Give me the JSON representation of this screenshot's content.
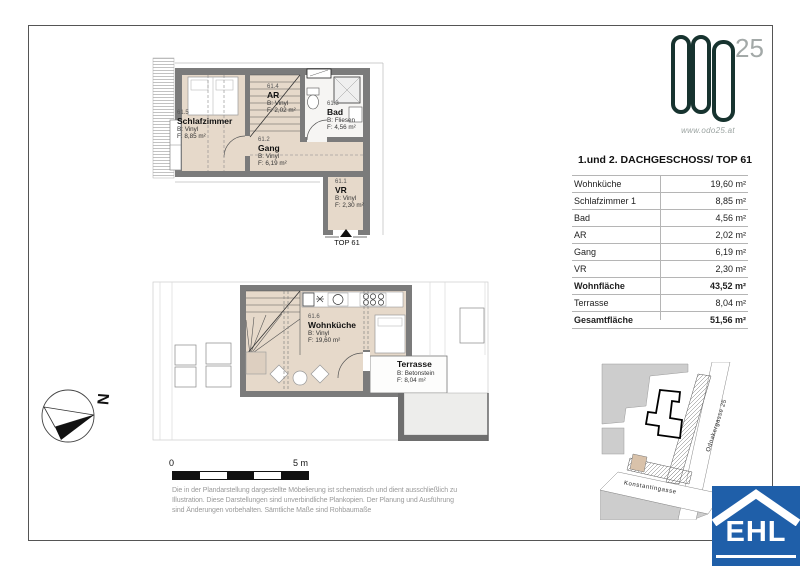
{
  "branding": {
    "logo_number": "25",
    "website": "www.odo25.at",
    "logo_color": "#17332f"
  },
  "title_block": {
    "title": "1.und 2. DACHGESCHOSS/ TOP 61"
  },
  "area_table": {
    "rows": [
      {
        "label": "Wohnküche",
        "value": "19,60 m²",
        "bold": false
      },
      {
        "label": "Schlafzimmer 1",
        "value": "8,85 m²",
        "bold": false
      },
      {
        "label": "Bad",
        "value": "4,56 m²",
        "bold": false
      },
      {
        "label": "AR",
        "value": "2,02 m²",
        "bold": false
      },
      {
        "label": "Gang",
        "value": "6,19 m²",
        "bold": false
      },
      {
        "label": "VR",
        "value": "2,30 m²",
        "bold": false
      },
      {
        "label": "Wohnfläche",
        "value": "43,52 m²",
        "bold": true
      },
      {
        "label": "Terrasse",
        "value": "8,04 m²",
        "bold": false
      },
      {
        "label": "Gesamtfläche",
        "value": "51,56 m²",
        "bold": true
      }
    ]
  },
  "plans": {
    "upper": {
      "rooms": {
        "schlafzimmer": {
          "number": "61.5",
          "name": "Schlafzimmer",
          "flooring": "B: Vinyl",
          "area": "F: 8,85 m²"
        },
        "ar": {
          "number": "61.4",
          "name": "AR",
          "flooring": "B: Vinyl",
          "area": "F: 2,02 m²"
        },
        "bad": {
          "number": "61.3",
          "name": "Bad",
          "flooring": "B: Fliesen",
          "area": "F: 4,56 m²"
        },
        "gang": {
          "number": "61.2",
          "name": "Gang",
          "flooring": "B: Vinyl",
          "area": "F: 6,19 m²"
        },
        "vr": {
          "number": "61.1",
          "name": "VR",
          "flooring": "B: Vinyl",
          "area": "F: 2,30 m²"
        }
      },
      "entrance_label": "TOP 61"
    },
    "lower": {
      "rooms": {
        "wohnkueche": {
          "number": "61.6",
          "name": "Wohnküche",
          "flooring": "B: Vinyl",
          "area": "F: 19,60 m²"
        },
        "terrasse": {
          "name": "Terrasse",
          "flooring": "B: Betonstein",
          "area": "F: 8,04 m²"
        }
      }
    }
  },
  "compass": {
    "label": "N"
  },
  "scale_bar": {
    "start_label": "0",
    "end_label": "5 m"
  },
  "disclaimer": {
    "lines": [
      "Die in der Plandarstellung dargestellte Möbelierung ist schematisch und dient ausschließlich zu",
      "Illustration. Diese Darstellungen sind unverbindliche Plankopien. Der Planung und Ausführung",
      "sind Änderungen vorbehalten. Sämtliche Maße sind Rohbaumaße"
    ]
  },
  "site_plan": {
    "streets": [
      "Odoakergasse 25",
      "Konstantingasse"
    ]
  },
  "ehl": {
    "label": "EHL",
    "color": "#1f5fa9"
  }
}
